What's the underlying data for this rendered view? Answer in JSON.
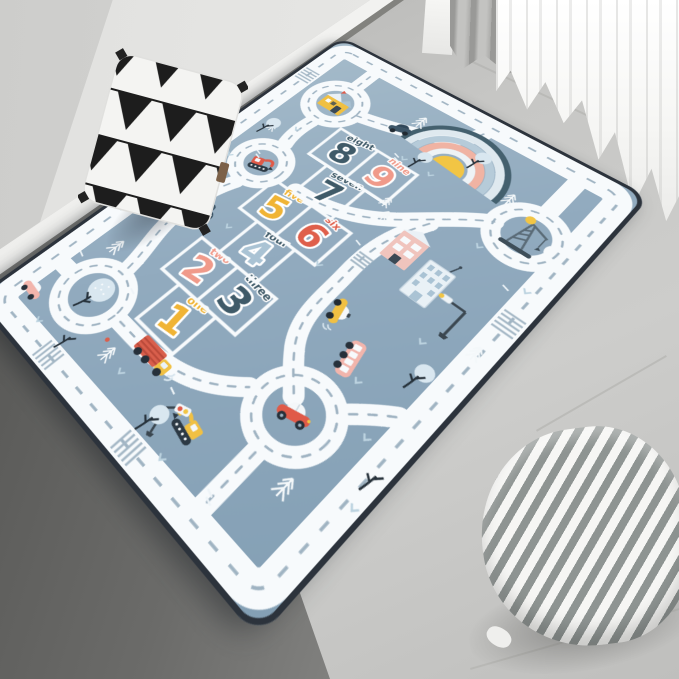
{
  "image_type": "product-photo of kids hopscotch road play rug in room corner",
  "room": {
    "wall_color": "#e6e6e4",
    "wall_left_color": "#d2d2d0",
    "baseboard_color": "#f3f3f1",
    "floor_color": "#c6c6c4",
    "floor_shadow_color": "#5c5c5a",
    "curtain_white_color": "#fafafa",
    "curtain_gray_color": "#a9a9a7"
  },
  "rug": {
    "background_color": "#92abbf",
    "edge_color": "#2c333c",
    "road_color": "#f7fafc",
    "road_dash_color": "#9fb3c2",
    "hopscotch": {
      "squares": [
        {
          "digit": "1",
          "word": "one",
          "digit_color": "#f0b435",
          "word_color": "#f0b435"
        },
        {
          "digit": "2",
          "word": "two",
          "digit_color": "#f09a8a",
          "word_color": "#f09a8a"
        },
        {
          "digit": "3",
          "word": "three",
          "digit_color": "#3f5a68",
          "word_color": "#3f5a68"
        },
        {
          "digit": "4",
          "word": "four",
          "digit_color": "#aac3d4",
          "word_color": "#3f5a68"
        },
        {
          "digit": "5",
          "word": "five",
          "digit_color": "#f0b435",
          "word_color": "#f0b435"
        },
        {
          "digit": "6",
          "word": "six",
          "digit_color": "#df5f4b",
          "word_color": "#df5f4b"
        },
        {
          "digit": "7",
          "word": "seven",
          "digit_color": "#3f5a68",
          "word_color": "#3f5a68"
        },
        {
          "digit": "8",
          "word": "eight",
          "digit_color": "#3f5a68",
          "word_color": "#3f5a68"
        },
        {
          "digit": "9",
          "word": "nine",
          "digit_color": "#f09a8a",
          "word_color": "#f09a8a"
        }
      ]
    },
    "rainbow_colors": [
      "#44606e",
      "#dfe9ef",
      "#b6cbd9",
      "#f0b3a3",
      "#eef3f6",
      "#f2c544"
    ],
    "icons": [
      "house",
      "rainbow",
      "crane",
      "tree",
      "red-car",
      "sedan",
      "convertible",
      "taxi",
      "bus",
      "truck",
      "red-excavator",
      "yellow-excavator",
      "street-lamp",
      "traffic-light",
      "pink-building",
      "blue-building",
      "pink-car"
    ]
  },
  "pillows": {
    "triangle": {
      "base_color": "#f4f4f2",
      "pattern_color": "#1d1d1d"
    },
    "striped": {
      "stripe_color": "#8e9492",
      "base_color": "#f6f6f4"
    }
  }
}
